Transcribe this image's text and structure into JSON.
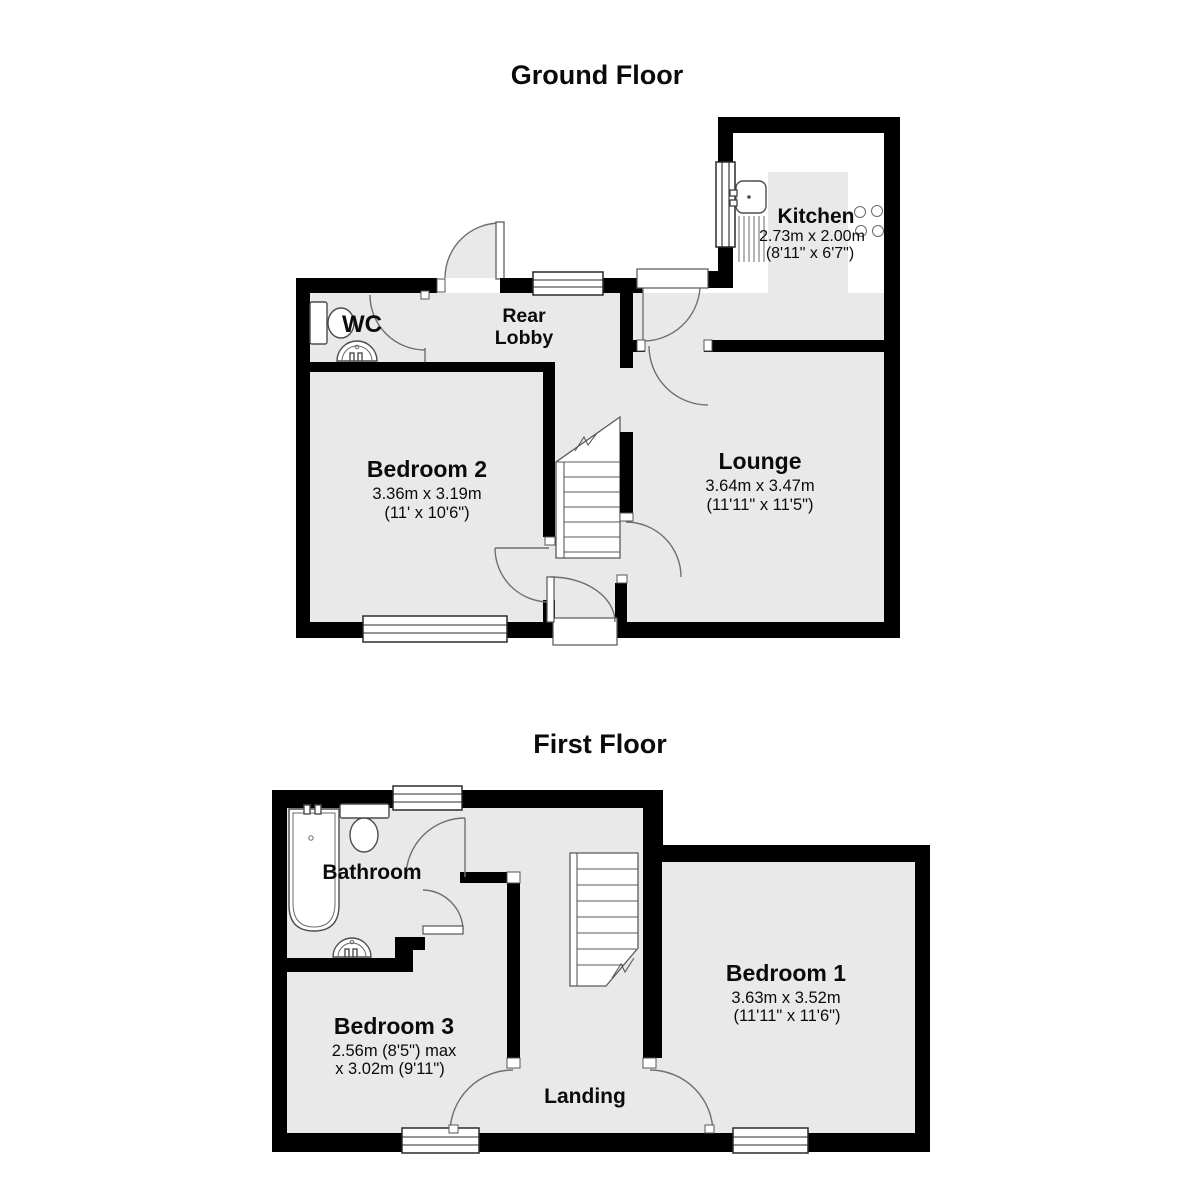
{
  "ground_floor": {
    "title": "Ground Floor",
    "rooms": {
      "kitchen": {
        "name": "Kitchen",
        "dim_metric": "2.73m x 2.00m",
        "dim_imperial": "(8'11\" x 6'7\")"
      },
      "wc": {
        "name": "WC"
      },
      "rear_lobby": {
        "name_line1": "Rear",
        "name_line2": "Lobby"
      },
      "bedroom2": {
        "name": "Bedroom 2",
        "dim_metric": "3.36m x 3.19m",
        "dim_imperial": "(11' x 10'6\")"
      },
      "lounge": {
        "name": "Lounge",
        "dim_metric": "3.64m x 3.47m",
        "dim_imperial": "(11'11\" x 11'5\")"
      }
    }
  },
  "first_floor": {
    "title": "First Floor",
    "rooms": {
      "bathroom": {
        "name": "Bathroom"
      },
      "bedroom3": {
        "name": "Bedroom 3",
        "dim_line1": "2.56m (8'5\") max",
        "dim_line2": "x 3.02m (9'11\")"
      },
      "bedroom1": {
        "name": "Bedroom 1",
        "dim_metric": "3.63m x 3.52m",
        "dim_imperial": "(11'11\" x 11'6\")"
      },
      "landing": {
        "name": "Landing"
      }
    }
  },
  "colors": {
    "wall": "#000000",
    "floor": "#e9e9e9",
    "background": "#ffffff",
    "fixture_outline": "#4d4d4d"
  }
}
